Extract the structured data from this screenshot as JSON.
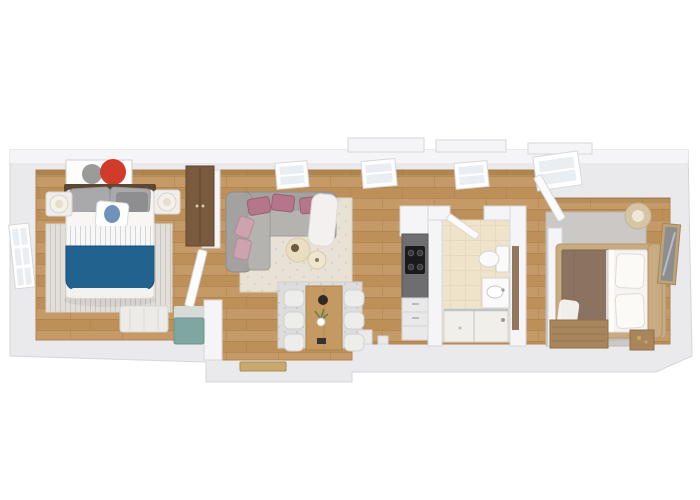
{
  "scene": {
    "description": "3D rendered top-down floor plan of a long narrow apartment with two bedrooms, living room, dining area, kitchen strip and bathroom",
    "style": "photoreal 3D render, white background"
  },
  "palette": {
    "background": "#ffffff",
    "wall": "#eaeaec",
    "wall_face": "#f5f5f7",
    "wall_edge": "#d6d6d9",
    "floor_wood": "#c59a66",
    "floor_wood_dark": "#b08350",
    "tile_floor": "#efe3cb",
    "tile_line": "#e0d2b2",
    "rug_striped": "#e2dfda",
    "rug_living": "#e7e1d6",
    "rug_dining": "#dddddd",
    "rug_bedroom2": "#cbc8c5",
    "bed_blue": "#21628f",
    "bed_white": "#f5f4f2",
    "pillow_grey": "#a9a9ab",
    "pillow_pink": "#b5758a",
    "pillow_pink_light": "#cda3b0",
    "sofa_grey": "#a3a2a0",
    "sofa_seat": "#b4b3b0",
    "throw_white": "#f2f1ef",
    "coffee_table": "#e9ddc4",
    "table_wood": "#c59a62",
    "chair_white": "#ededeb",
    "counter_dark": "#6e6e70",
    "cooktop": "#1a1a1d",
    "cabinet_white": "#e9e9ea",
    "wardrobe_wood": "#7a5a3e",
    "furniture_wood": "#a8855c",
    "bed2_brown": "#8b7361",
    "headboard_dark": "#5c4733",
    "headboard_light": "#c8ab80",
    "lamp_beige": "#d6c5a4",
    "teal": "#7fa6a1",
    "teal_base": "#d6dbd8",
    "art_red": "#d23b2a",
    "art_grey": "#9b9b99",
    "door_tan": "#c9a96e",
    "glass": "#e8eef1",
    "fixture_white": "#fafafa",
    "mirror": "#8d8d8f"
  },
  "rooms": [
    {
      "name": "bedroom-1",
      "furniture": [
        "double-bed-blue-blanket",
        "dark-headboard",
        "wall-art-red-grey-circles",
        "nightstand-left-with-lamp",
        "nightstand-right-with-lamp",
        "striped-area-rug",
        "wardrobe",
        "foot-bench",
        "side-window"
      ]
    },
    {
      "name": "entry-hall",
      "furniture": [
        "teal-bench",
        "entrance-door",
        "open-door"
      ]
    },
    {
      "name": "living-room",
      "furniture": [
        "corner-sofa-grey",
        "pink-accent-pillows",
        "white-throw",
        "round-coffee-tables",
        "speckled-rug",
        "skylight-windows"
      ]
    },
    {
      "name": "dining-area",
      "furniture": [
        "wood-dining-table",
        "six-white-chairs",
        "vase-with-flowers",
        "grey-rug"
      ]
    },
    {
      "name": "kitchen",
      "furniture": [
        "dark-countertop",
        "black-cooktop",
        "white-cabinets"
      ]
    },
    {
      "name": "bathroom",
      "furniture": [
        "toilet",
        "sink-vanity",
        "walk-in-shower",
        "open-door",
        "tiled-floor"
      ]
    },
    {
      "name": "bedroom-2",
      "furniture": [
        "double-bed-brown-blanket",
        "light-wood-headboard",
        "floor-lamp",
        "nightstand",
        "leaning-mirror",
        "wood-dresser",
        "grey-area-rug",
        "skylight-window"
      ]
    }
  ]
}
